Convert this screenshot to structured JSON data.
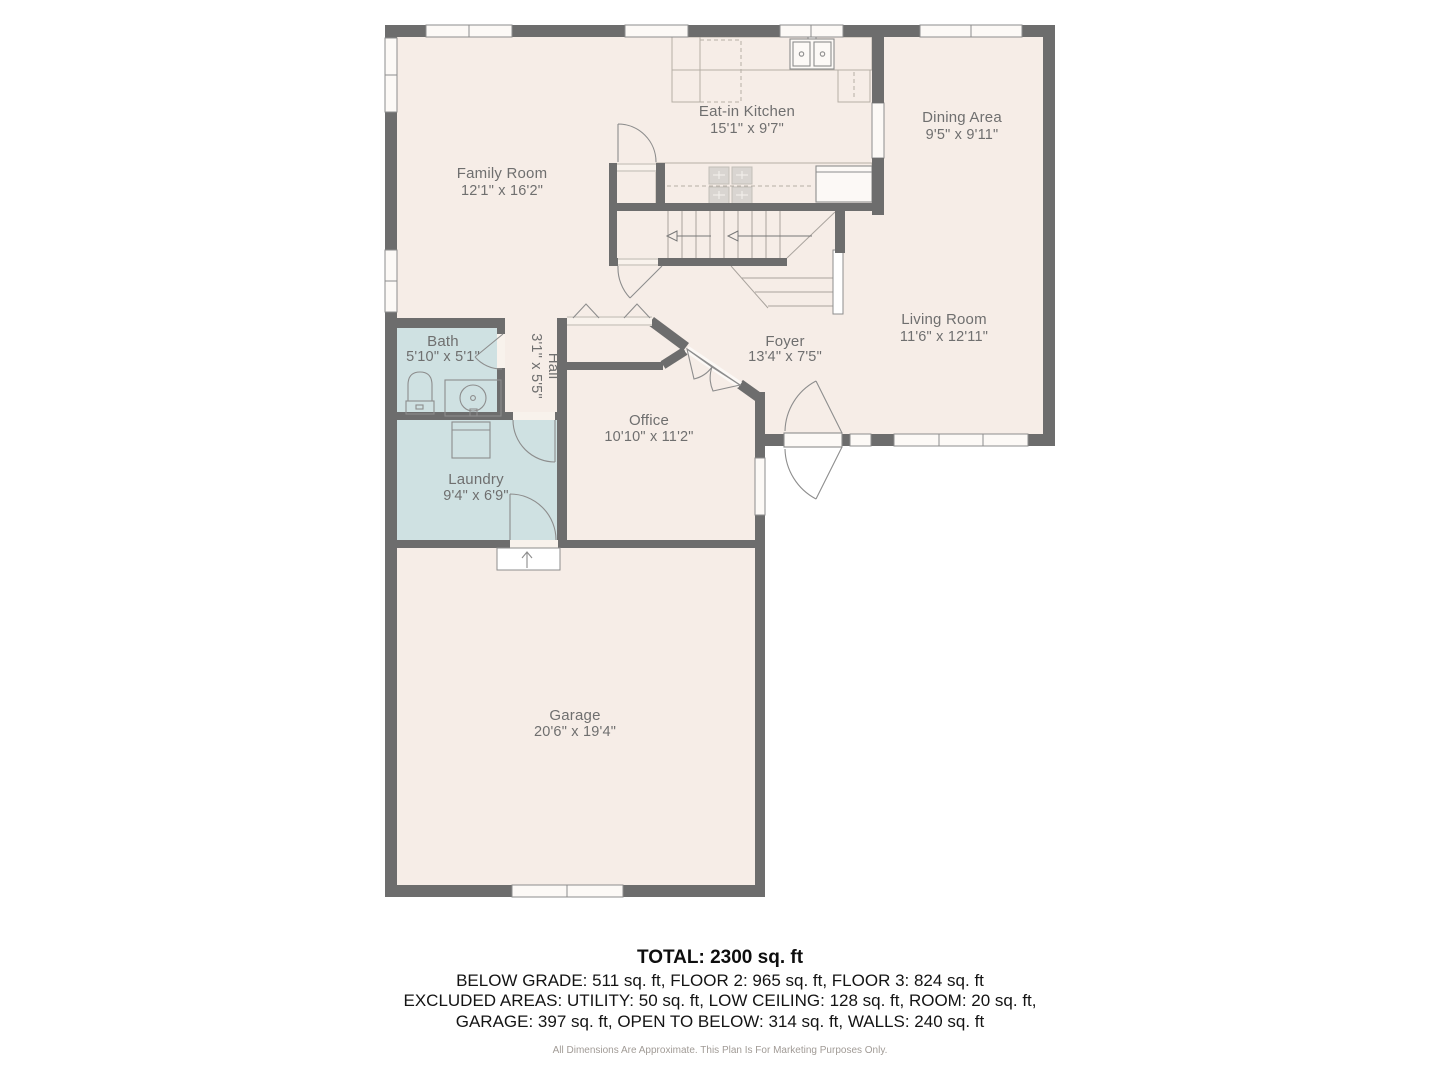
{
  "plan": {
    "rooms": [
      {
        "id": "family-room",
        "name": "Family Room",
        "dims": "12'1\" x 16'2\""
      },
      {
        "id": "eat-in-kitchen",
        "name": "Eat-in Kitchen",
        "dims": "15'1\" x 9'7\""
      },
      {
        "id": "dining-area",
        "name": "Dining Area",
        "dims": "9'5\" x 9'11\""
      },
      {
        "id": "living-room",
        "name": "Living Room",
        "dims": "11'6\" x 12'11\""
      },
      {
        "id": "foyer",
        "name": "Foyer",
        "dims": "13'4\" x 7'5\""
      },
      {
        "id": "office",
        "name": "Office",
        "dims": "10'10\" x 11'2\""
      },
      {
        "id": "bath",
        "name": "Bath",
        "dims": "5'10\" x 5'1\""
      },
      {
        "id": "hall",
        "name": "Hall",
        "dims": "3'1\" x 5'5\""
      },
      {
        "id": "laundry",
        "name": "Laundry",
        "dims": "9'4\" x 6'9\""
      },
      {
        "id": "garage",
        "name": "Garage",
        "dims": "20'6\" x 19'4\""
      }
    ],
    "colors": {
      "floor": "#f6ede7",
      "wet_room": "#cfe1e2",
      "wall": "#6d6d6d",
      "label": "#6f6f6f"
    }
  },
  "summary": {
    "total": "TOTAL: 2300 sq. ft",
    "line1": "BELOW GRADE: 511 sq. ft, FLOOR 2: 965 sq. ft, FLOOR 3: 824 sq. ft",
    "line2": "EXCLUDED AREAS: UTILITY: 50 sq. ft, LOW CEILING: 128 sq. ft, ROOM: 20 sq. ft,",
    "line3": "GARAGE: 397 sq. ft, OPEN TO BELOW: 314 sq. ft, WALLS: 240 sq. ft",
    "disclaimer": "All Dimensions Are Approximate. This Plan Is For Marketing Purposes Only."
  }
}
